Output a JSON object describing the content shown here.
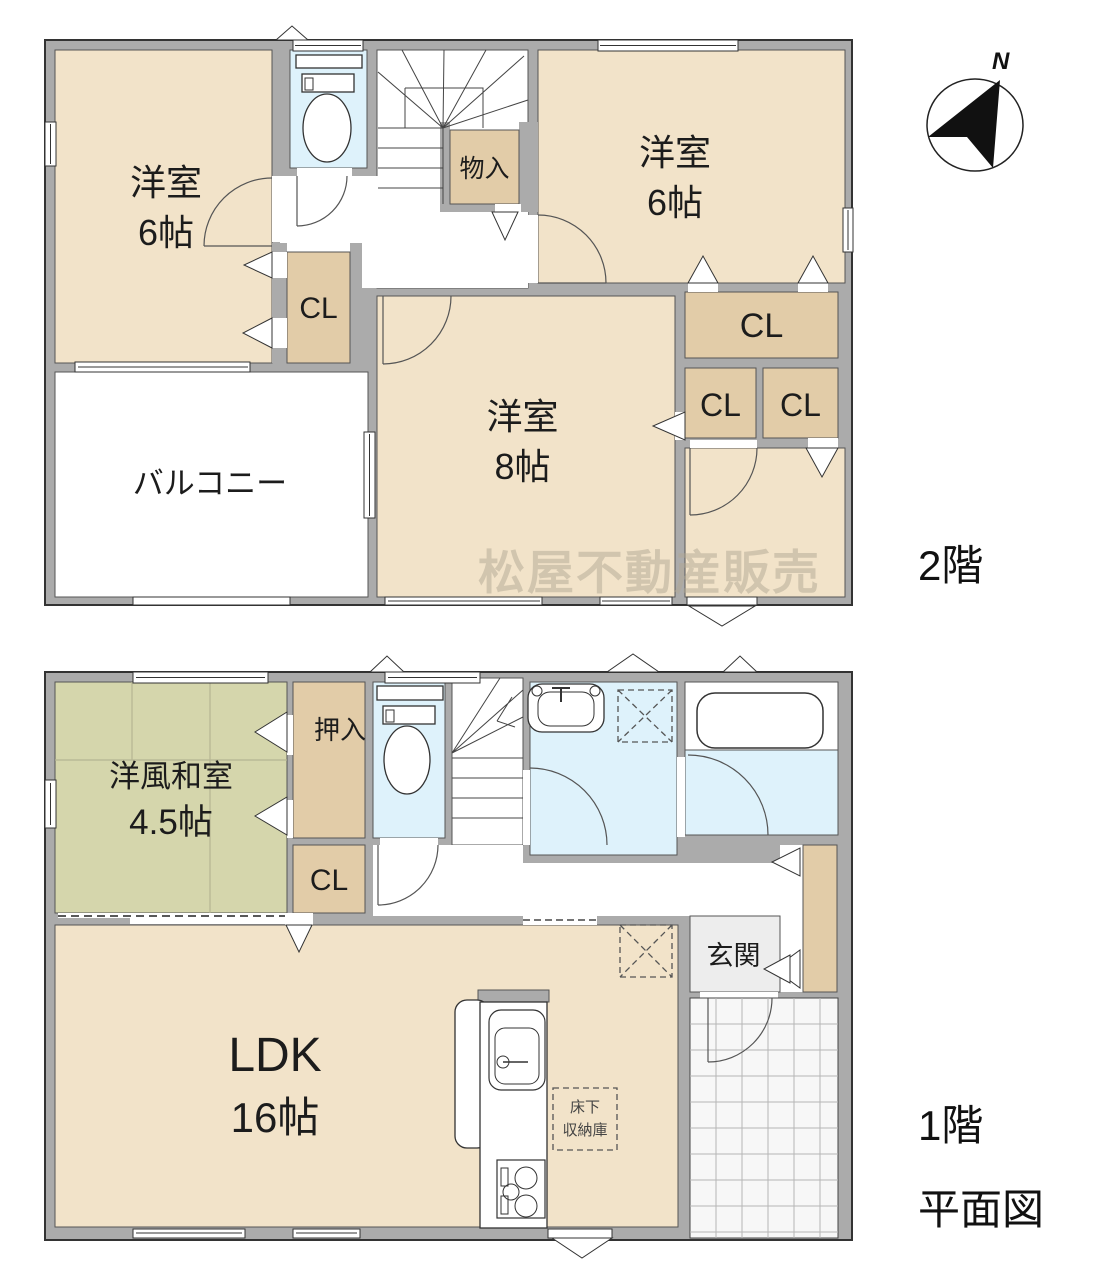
{
  "title": "住宅間取り図",
  "watermark": "松屋不動産販売",
  "compass": {
    "north_label": "N"
  },
  "colors": {
    "wall_gray": "#ababab",
    "room_beige": "#f2e3c9",
    "closet_tan": "#e2cca8",
    "tatami_green": "#d5d6ac",
    "water_blue": "#def2fb",
    "entrance_gray": "#ededed"
  },
  "floor2": {
    "label": "2階",
    "rooms": {
      "bedroom_left": {
        "name": "洋室",
        "size": "6帖"
      },
      "bedroom_right": {
        "name": "洋室",
        "size": "6帖"
      },
      "bedroom_main": {
        "name": "洋室",
        "size": "8帖"
      },
      "storage": "物入",
      "closet": "CL",
      "balcony": "バルコニー"
    }
  },
  "floor1": {
    "label": "1階",
    "sublabel": "平面図",
    "rooms": {
      "japanese_room": {
        "name": "洋風和室",
        "size": "4.5帖"
      },
      "oshiire": "押入",
      "closet": "CL",
      "entrance": "玄関",
      "ldk": {
        "name": "LDK",
        "size": "16帖"
      },
      "underfloor_storage": {
        "line1": "床下",
        "line2": "収納庫"
      }
    }
  }
}
